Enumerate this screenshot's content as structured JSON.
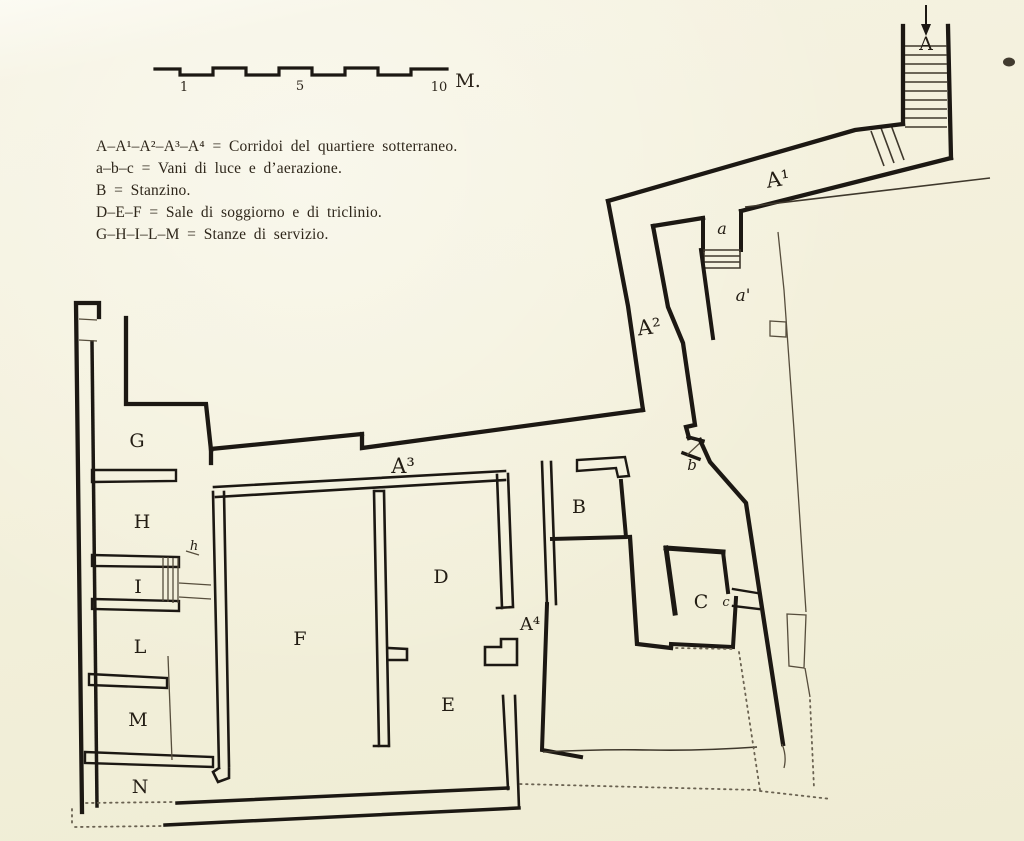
{
  "document": {
    "type": "scanned architectural floor plan, underground quarter (quartiere sotterraneo)",
    "language": "Italian"
  },
  "legend": {
    "lines": [
      "A–A¹–A²–A³–A⁴ = Corridoi del quartiere sotterraneo.",
      "a–b–c = Vani di luce e d’aerazione.",
      "B = Stanzino.",
      "D–E–F = Sale di soggiorno e di triclinio.",
      "G–H–I–L–M = Stanze di servizio."
    ]
  },
  "scale_bar": {
    "ticks": [
      {
        "t": "1",
        "x": 184,
        "y": 91
      },
      {
        "t": "5",
        "x": 300,
        "y": 90
      },
      {
        "t": "10",
        "x": 439,
        "y": 91
      }
    ],
    "unit": {
      "t": "M.",
      "x": 468,
      "y": 87
    }
  },
  "plan": {
    "labels": [
      {
        "t": "A",
        "x": 926,
        "y": 50,
        "s": 19
      },
      {
        "t": "A¹",
        "x": 779,
        "y": 186,
        "s": 21,
        "r": -9
      },
      {
        "t": "a",
        "x": 722,
        "y": 234,
        "s": 16,
        "i": 1
      },
      {
        "t": "a'",
        "x": 743,
        "y": 301,
        "s": 17,
        "i": 1
      },
      {
        "t": "A²",
        "x": 650,
        "y": 334,
        "s": 21,
        "r": -7
      },
      {
        "t": "b",
        "x": 692,
        "y": 470,
        "s": 15,
        "i": 1
      },
      {
        "t": "B",
        "x": 579,
        "y": 513,
        "s": 19
      },
      {
        "t": "C",
        "x": 701,
        "y": 608,
        "s": 19
      },
      {
        "t": "c",
        "x": 726,
        "y": 606,
        "s": 13,
        "i": 1
      },
      {
        "t": "A³",
        "x": 403,
        "y": 473,
        "s": 21
      },
      {
        "t": "A⁴",
        "x": 530,
        "y": 630,
        "s": 18
      },
      {
        "t": "D",
        "x": 441,
        "y": 583,
        "s": 19
      },
      {
        "t": "E",
        "x": 448,
        "y": 711,
        "s": 19
      },
      {
        "t": "F",
        "x": 300,
        "y": 645,
        "s": 19
      },
      {
        "t": "G",
        "x": 137,
        "y": 447,
        "s": 19
      },
      {
        "t": "H",
        "x": 142,
        "y": 528,
        "s": 19
      },
      {
        "t": "h",
        "x": 194,
        "y": 550,
        "s": 13,
        "i": 1
      },
      {
        "t": "I",
        "x": 138,
        "y": 593,
        "s": 19
      },
      {
        "t": "L",
        "x": 140,
        "y": 653,
        "s": 19
      },
      {
        "t": "M",
        "x": 138,
        "y": 726,
        "s": 19
      },
      {
        "t": "N",
        "x": 140,
        "y": 793,
        "s": 19
      }
    ]
  },
  "colors": {
    "paper": "#f3f0db",
    "ink": "#1c1813",
    "thin_line": "#564d3c",
    "dotted_line": "#6a6251"
  }
}
